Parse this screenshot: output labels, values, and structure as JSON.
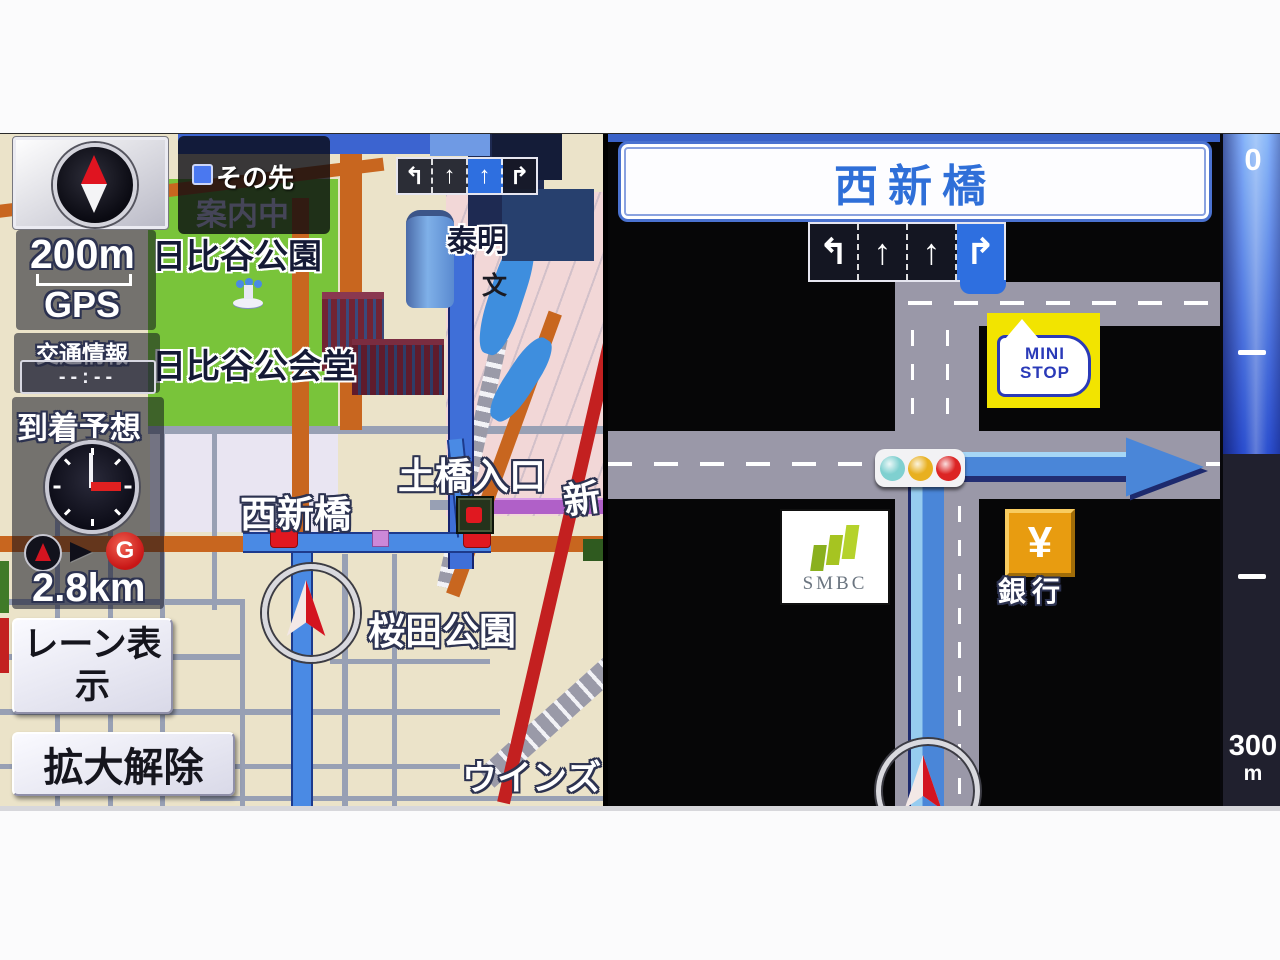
{
  "left_panel": {
    "zoom_scale_label": "200m",
    "gps_label": "GPS",
    "traffic_info": {
      "label": "交通情報",
      "time_value": "--:--"
    },
    "arrival": {
      "label": "到着予想"
    },
    "goal": {
      "marker_letter": "G",
      "distance": "2.8km"
    },
    "next_guidance": {
      "label": "その先",
      "status": "案内中"
    },
    "lane_bar": {
      "lanes": [
        "↰",
        "↑",
        "↑",
        "↱"
      ],
      "active_index": 2
    },
    "buttons": {
      "lane_display": "レーン表示",
      "zoom_cancel": "拡大解除"
    },
    "map_labels": {
      "park1": "日比谷公園",
      "hall": "日比谷公会堂",
      "taimei": "泰明",
      "school": "文",
      "nishishinbashi": "西新橋",
      "dobashi": "土橋入口",
      "shin": "新",
      "sakurada": "桜田公園",
      "wins": "ウインズ"
    }
  },
  "right_panel": {
    "title": "西新橋",
    "lane_bar": {
      "lanes": [
        "↰",
        "↑",
        "↑",
        "↱"
      ],
      "active_index": 3
    },
    "poi": {
      "ministop": {
        "line1": "MINI",
        "line2": "STOP"
      },
      "smbc": {
        "label": "SMBC"
      },
      "bank": {
        "symbol": "¥",
        "label": "銀行"
      }
    },
    "scale_bar": {
      "top": "0",
      "bottom_value": "300",
      "bottom_unit": "m"
    }
  },
  "colors": {
    "route_blue": "#4a86d8",
    "route_light": "#9cd0f2",
    "road_gray": "#9a98a8",
    "park_green": "#79c43a",
    "road_orange": "#c8661f",
    "road_red": "#c32020",
    "road_purple": "#b060c8",
    "title_blue": "#2f6fd8",
    "lane_highlight": "#2e6fe0",
    "ministop_yellow": "#f2e400",
    "bank_amber": "#e89c10"
  }
}
